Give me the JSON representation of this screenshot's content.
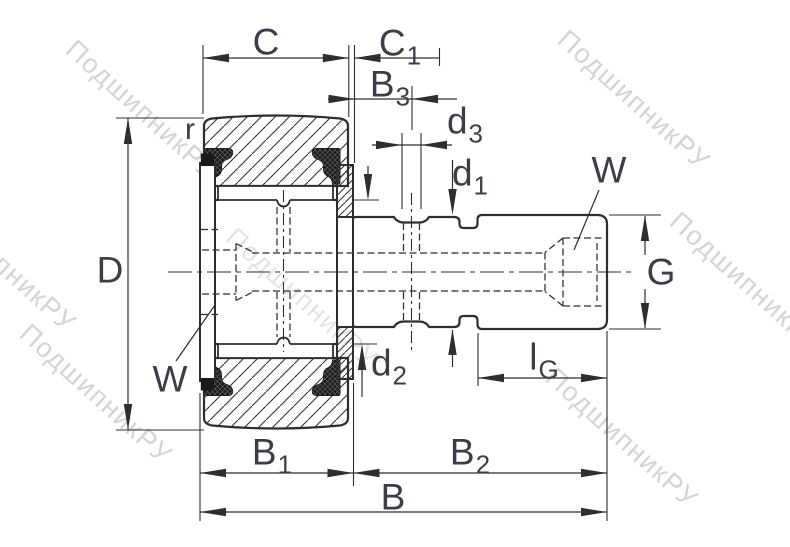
{
  "meta": {
    "type": "technical-drawing",
    "subject": "stud-type track roller (cam follower) cross-section with dimension callouts"
  },
  "watermark": {
    "text": "ПодшипникРУ"
  },
  "labels": {
    "r": "r",
    "C": "C",
    "D": "D",
    "G": "G",
    "B": "B",
    "W_left": "W",
    "W_right": "W",
    "C1": {
      "base": "C",
      "sub": "1"
    },
    "B3": {
      "base": "B",
      "sub": "3"
    },
    "d3": {
      "base": "d",
      "sub": "3"
    },
    "d1": {
      "base": "d",
      "sub": "1"
    },
    "d2": {
      "base": "d",
      "sub": "2"
    },
    "lG": {
      "base": "l",
      "sub": "G"
    },
    "B1": {
      "base": "B",
      "sub": "1"
    },
    "B2": {
      "base": "B",
      "sub": "2"
    }
  },
  "colors": {
    "background": "#ffffff",
    "line": "#2e2e2e",
    "label": "#3a3f47",
    "seal": "#1a1a1a",
    "watermark": "#aeb2b8"
  }
}
